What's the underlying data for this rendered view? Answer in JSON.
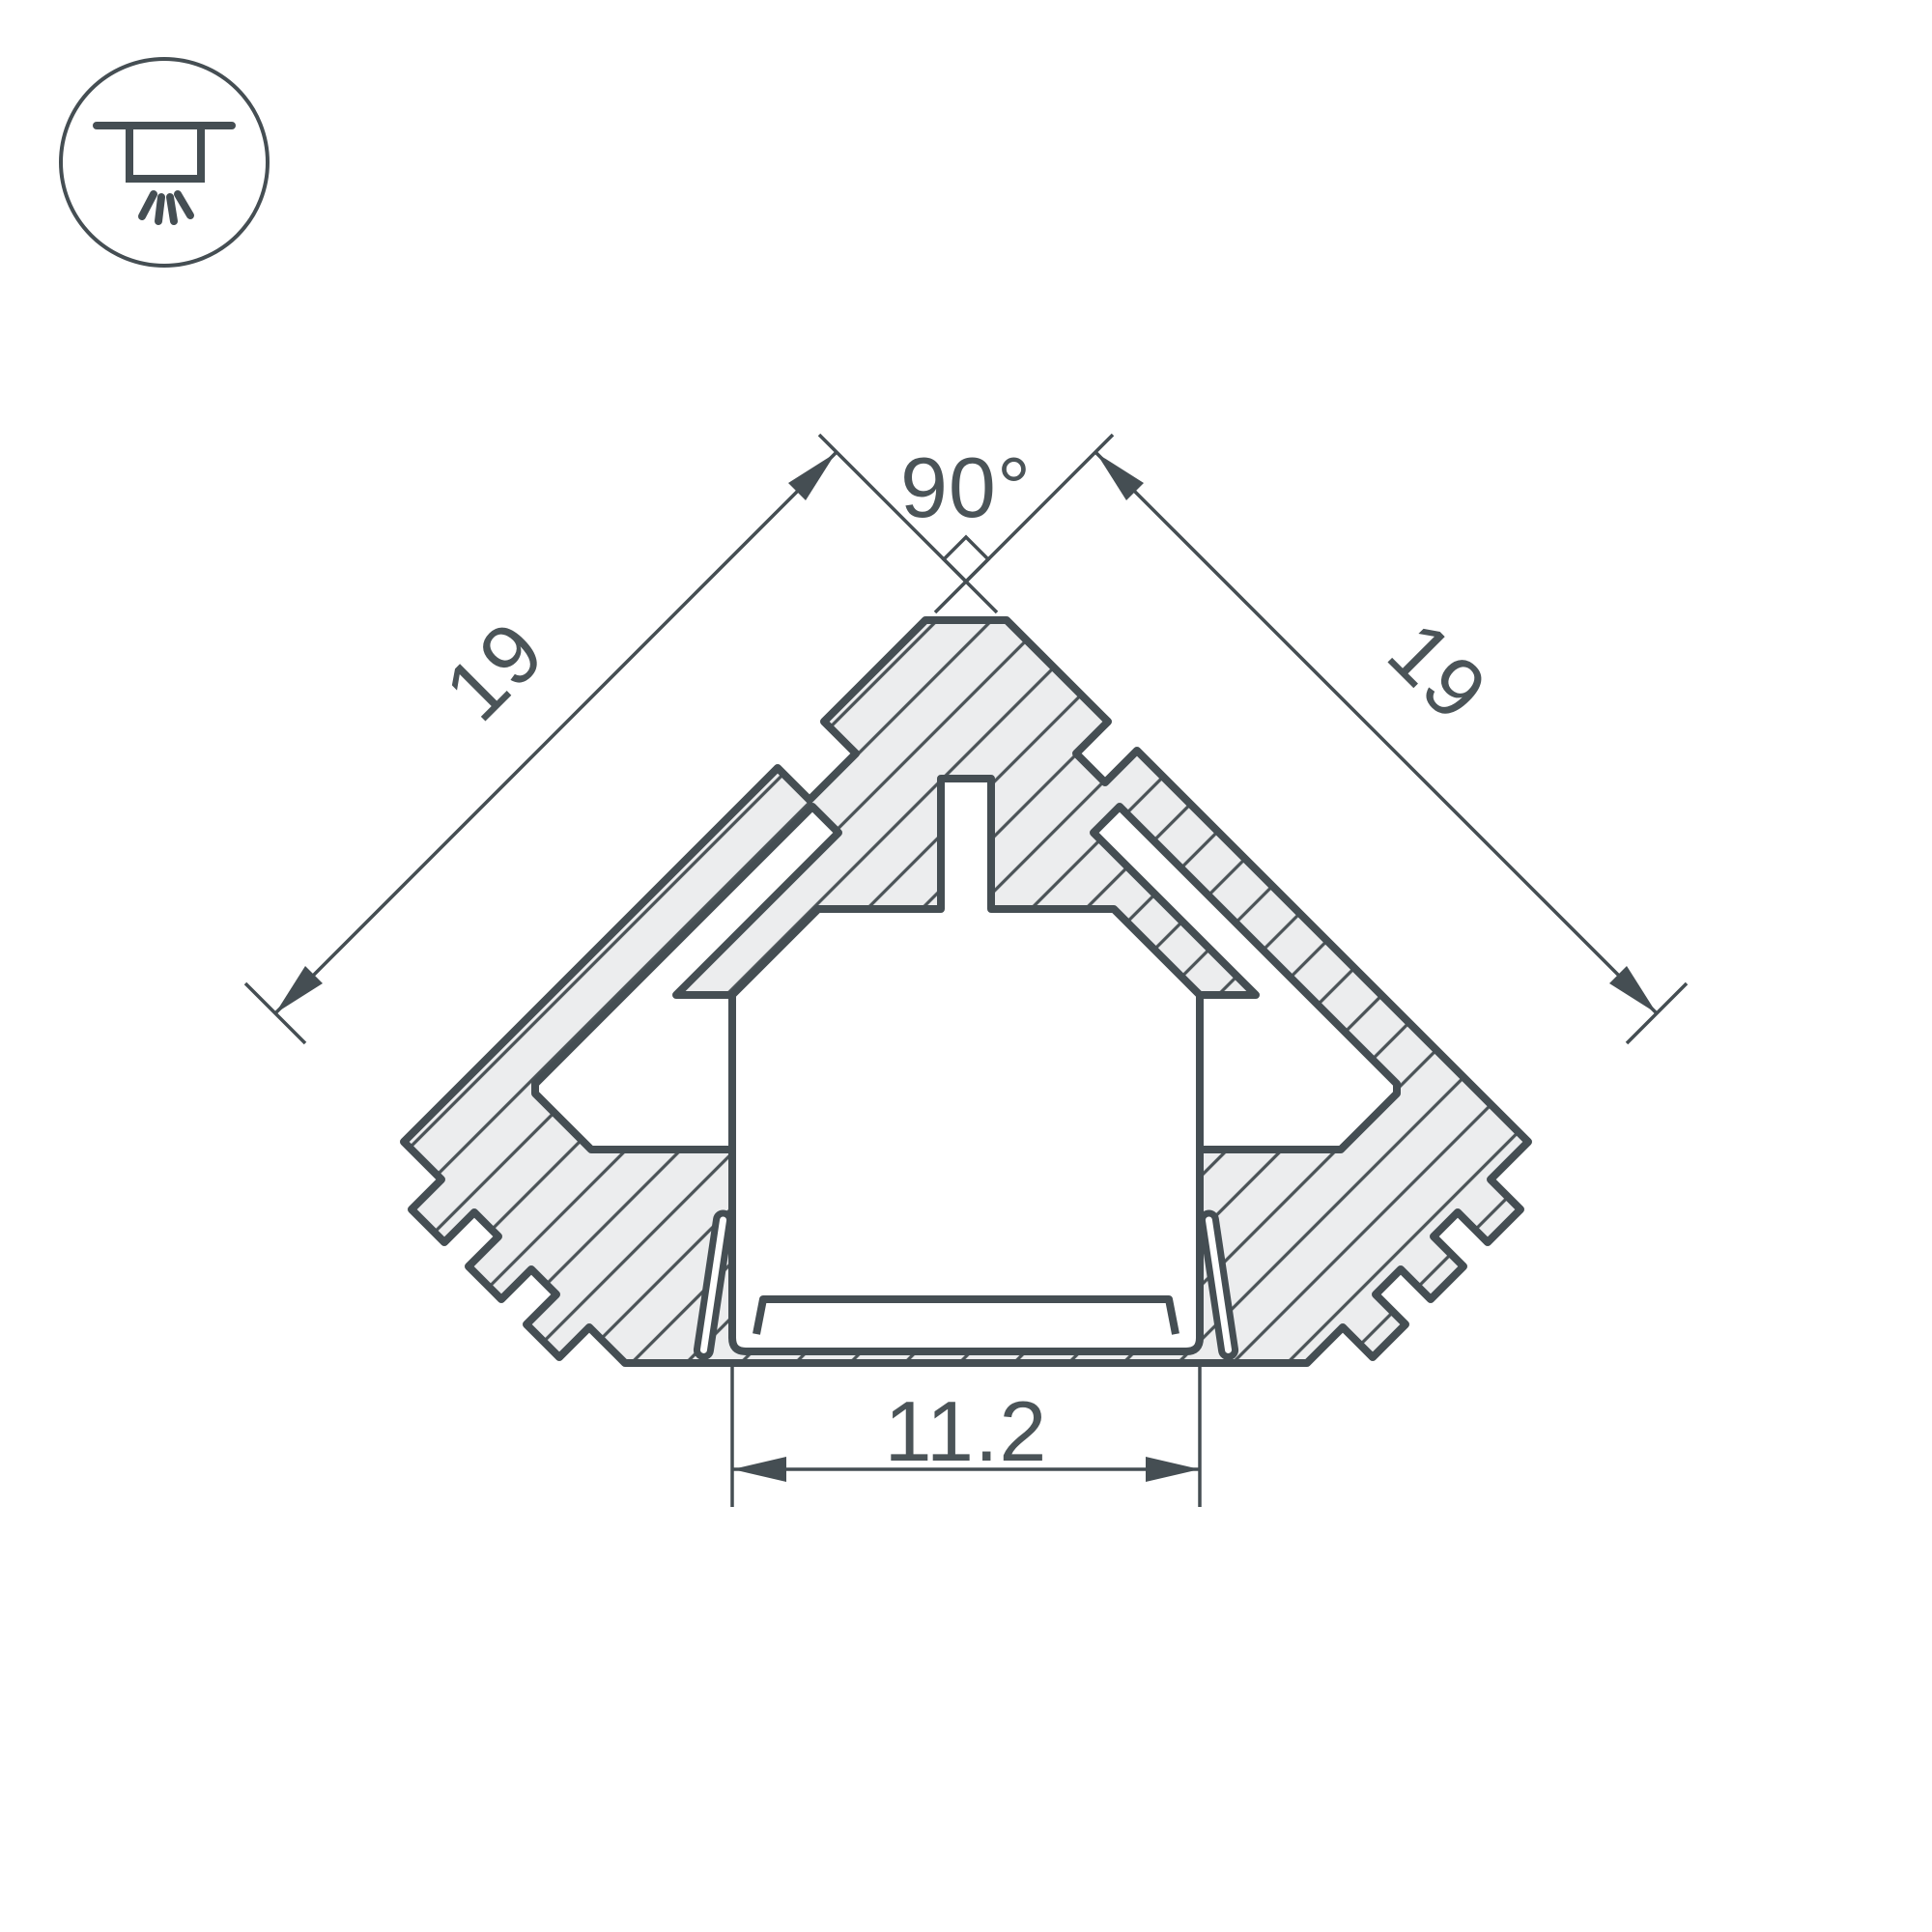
{
  "drawing": {
    "title": "corner-profile-cross-section",
    "icon": {
      "name": "recessed-ceiling-light-icon"
    },
    "colors": {
      "line": "#454e53",
      "fill": "#ecedee",
      "hatch": "#4b5357",
      "text": "#4b5458",
      "background": "#ffffff"
    },
    "dimensions": {
      "angle_top": "90°",
      "side_left": "19",
      "side_right": "19",
      "bottom_opening": "11.2"
    }
  }
}
